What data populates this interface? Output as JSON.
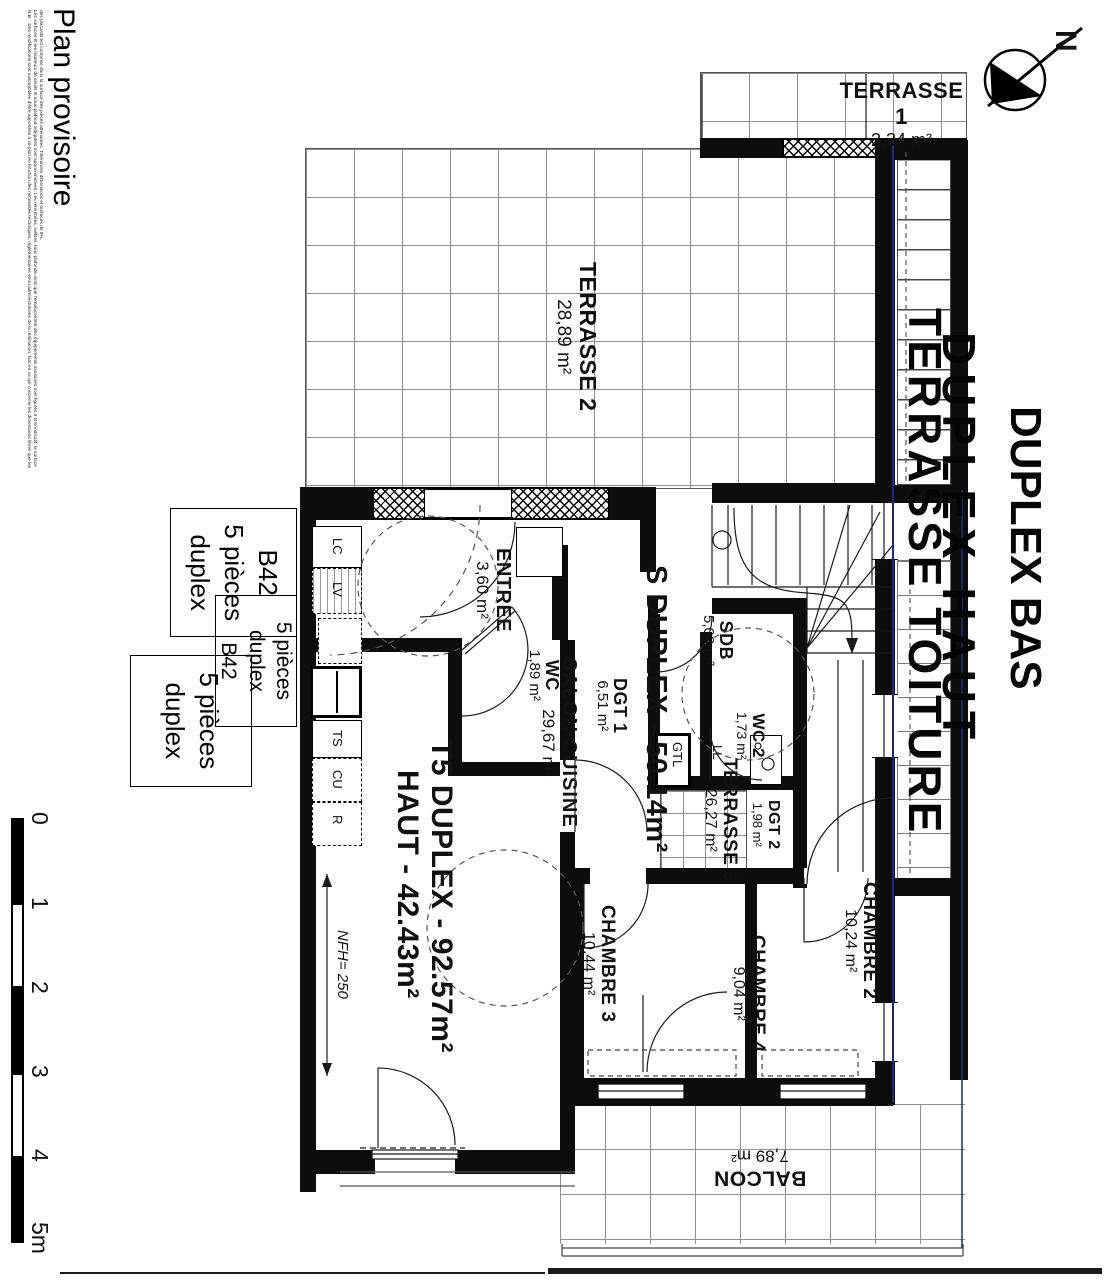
{
  "sheet": {
    "status_label": "Plan provisoire",
    "disclaimer_line1": "N.B. : Des modifications sont susceptibles d'être apportées à ce plan en fonction des nécessités techniques, réglementaires et/ou administratives de la réalisation, tant en ce qui concerne les dimensions libres que les",
    "disclaimer_line2": "Les surfaces et les hauteurs de seuils et sous-plafond indiquées sont approximatives. Les retombées, soffites, faux-plafonds ainsi que l'emplacement des équipements sanitaires sont figurés à titre indicatif, la surface",
    "disclaimer_line3": "des placards est comprise dans la surface des pièces attenantes. Tolérances dimensions et surfaces de 5%.",
    "compass_north": "N"
  },
  "scalebar": {
    "l0": "0",
    "l1": "1",
    "l2": "2",
    "l3": "3",
    "l4": "4",
    "l5": "5m"
  },
  "unit_labels": {
    "box1": {
      "line1": "B42",
      "line2": "5 pièces",
      "line3": "duplex"
    },
    "box2": {
      "line1": "5 pièces",
      "line2": "duplex",
      "line3": "B42"
    },
    "box3": {
      "line1": "5 pièces",
      "line2": "duplex"
    }
  },
  "level_labels": {
    "terrasse_toiture": "TERRASSE TOITURE",
    "duplex_haut": "DUPLEX HAUT",
    "duplex_bas": "DUPLEX BAS"
  },
  "area_summary": {
    "bas": "S DUPLEX - 50.14m²",
    "haut_line1": "T5 DUPLEX - 92.57m²",
    "haut_line2": "HAUT - 42.43m²"
  },
  "rooms": {
    "terrasse1": {
      "name": "TERRASSE 1",
      "area": "2,34 m²"
    },
    "terrasse2": {
      "name": "TERRASSE 2",
      "area": "28,89 m²"
    },
    "terrasse3": {
      "name": "TERRASSE 3",
      "area": "26,27 m²"
    },
    "entree": {
      "name": "ENTREE",
      "area": "3,60 m²"
    },
    "wc": {
      "name": "WC",
      "area": "1,89 m²"
    },
    "salon_cuisine": {
      "name": "SALON CUISINE",
      "area": "29,67 m²"
    },
    "dgt1": {
      "name": "DGT 1",
      "area": "6,51 m²"
    },
    "sdb": {
      "name": "SDB",
      "area": "5,08 m²"
    },
    "wc2": {
      "name": "WC 2",
      "area": "1,73 m²"
    },
    "dgt2": {
      "name": "DGT 2",
      "area": "1,98 m²"
    },
    "chambre2": {
      "name": "CHAMBRE 2",
      "area": "10,24 m²"
    },
    "chambre3": {
      "name": "CHAMBRE 3",
      "area": "10,44 m²"
    },
    "chambre4": {
      "name": "CHAMBRE 4",
      "area": "9,04 m²"
    },
    "balcon": {
      "name": "BALCON",
      "area": "7,89 m²"
    }
  },
  "fixtures": {
    "lc": "LC",
    "lv": "LV",
    "ts": "TS",
    "cu": "CU",
    "r": "R",
    "ll": "LL",
    "gtl": "GTL"
  },
  "dimensions": {
    "nfh": "NFH= 250"
  }
}
